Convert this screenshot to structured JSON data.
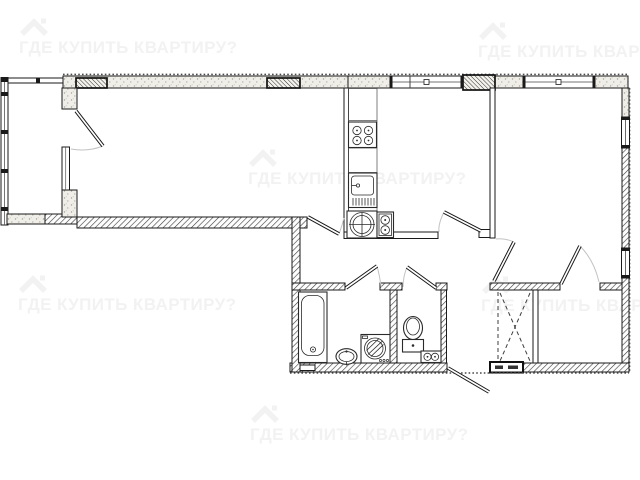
{
  "watermark": {
    "text": "ГДЕ КУПИТЬ КВАРТИРУ?",
    "icon": "house-roof-logo-icon",
    "instances": 6
  },
  "floorplan": {
    "icons": {
      "stove-icon": "square with 4 burner circles",
      "kitchen-sink-icon": "basin with drainboard comb",
      "round-sink-icon": "circle with cross in square",
      "water-heater-icon": "tall box with two circles",
      "bathtub-icon": "rounded tub with drain",
      "washbasin-icon": "oval pedestal sink",
      "washing-machine-icon": "square with hatched drum circle",
      "toilet-icon": "oval bowl with cistern",
      "water-meters-icon": "box with two dial circles",
      "wardrobe-icon": "dashed X cross",
      "door-swing-icon": "angled double-line door leaf",
      "window-icon": "white opening with frame lines"
    }
  },
  "css_vars": {
    "--wm-color": "#f2f2f2",
    "--wall-line": "#1a1a1a",
    "--bg": "#ffffff"
  }
}
